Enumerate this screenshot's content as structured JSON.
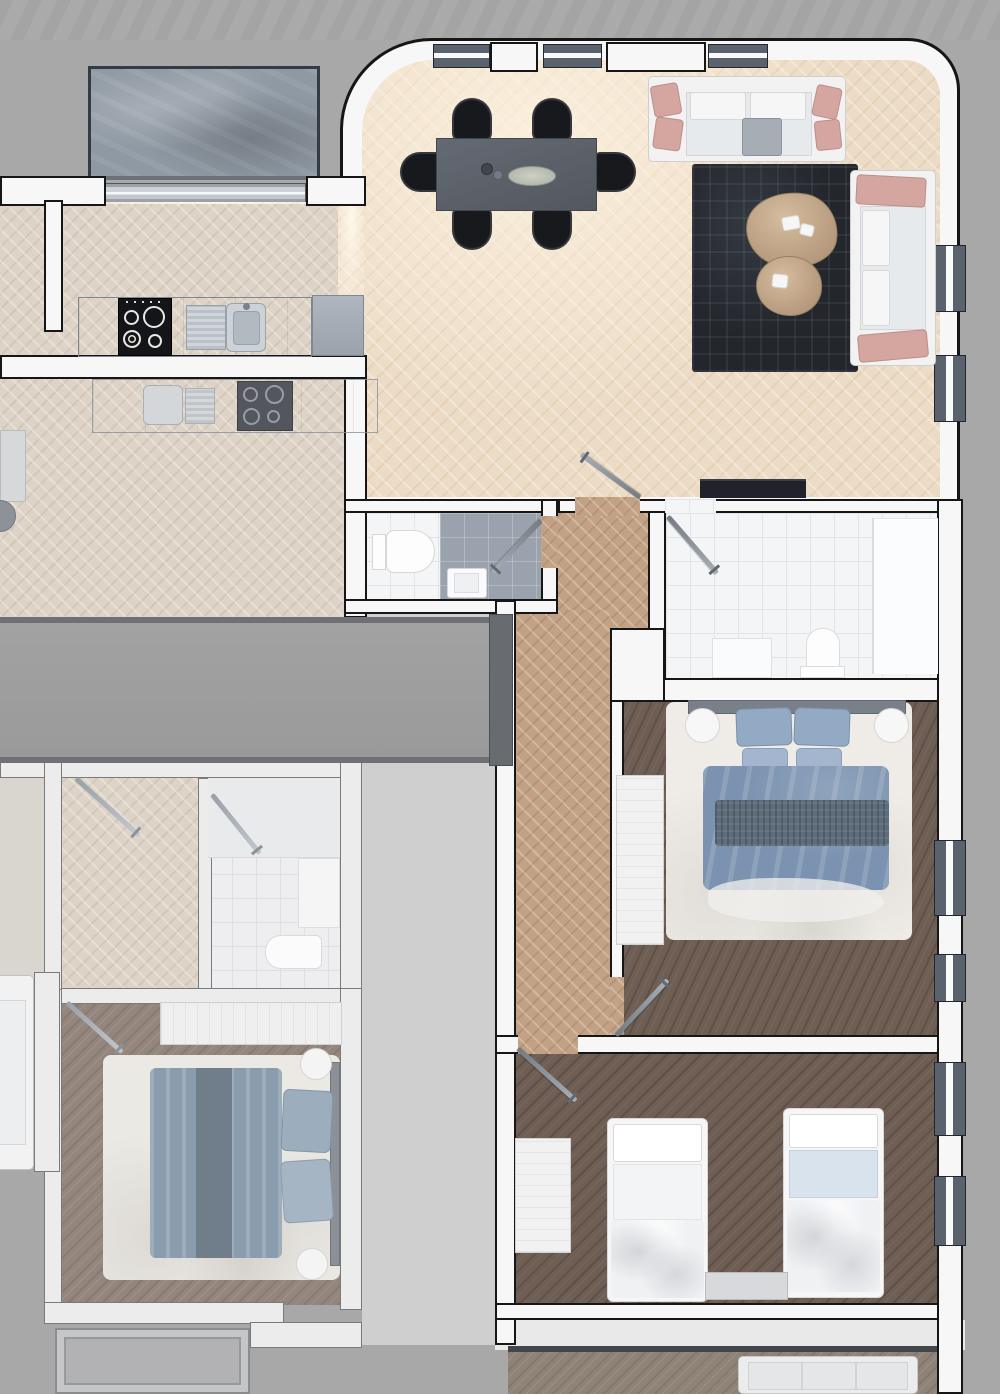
{
  "title": "apartment-building-floor-plan-render",
  "palette": {
    "bg": "#a8a8a8",
    "stripe_a": "#a1a1a1",
    "stripe_b": "#acacac",
    "wall_fill": "#f7f7f7",
    "wall_line": "#161616",
    "washed_wall_fill": "#ececec",
    "washed_wall_line": "#7a7a7a",
    "window_frame": "#5a626e",
    "glass_white": "#fafafa",
    "floor_living": "#ecdcc6",
    "floor_kitchen": "#f4e6d2",
    "floor_hall": "#c2a184",
    "floor_wood": "#6f5e53",
    "floor_wood_washed": "#94867c",
    "floor_corridor": "#9e9e9e",
    "gap_gray": "#cfcfcf",
    "tile_white": "#f4f5f7",
    "tile_line": "#e2e4e8",
    "shower_gray": "#9aa3ad",
    "rug_dark": "#23262c",
    "rug_light": "#efece7",
    "sofa_white": "#f2f2f2",
    "seat_gray": "#e7eaed",
    "pillow_blush": "#d5a6a0",
    "table_dark": "#5b6169",
    "chair_black": "#17191d",
    "wood_table": "#c4ab8d",
    "counter_gray": "#a0a9b2",
    "steel": "#c9d0d6",
    "cooktop_black": "#141518",
    "duvet_blue": "#7b93b0",
    "duvet_dark": "#5e6d7b",
    "pillow_blue": "#93aac4",
    "bed_white": "#f6f6f7",
    "blanket_blue": "#d9e3ed",
    "washed_duvet": "#8a9dae",
    "washed_duvet_dark": "#6d7a86",
    "stone": "#8f99a3",
    "terrace_border": "#343b42",
    "door_gray": "#8a9098",
    "balcony": "#b2b2b4",
    "tv_dark": "#202329",
    "corridor_wall": "#6e7074"
  },
  "scene": {
    "view": "top-down-3d-render",
    "units": [
      {
        "id": "main-apartment",
        "rooms": [
          {
            "name": "living-dining-room",
            "floor": "light-herringbone-parquet",
            "furniture": [
              "dining-table",
              "dining-chairs-x6",
              "serving-platter",
              "sofa-top",
              "sofa-right",
              "dark-area-rug",
              "coffee-table-large",
              "coffee-table-small",
              "tv-sideboard"
            ]
          },
          {
            "name": "kitchen-nook",
            "floor": "light-herringbone-parquet",
            "furniture": [
              "counter",
              "cooktop-4-burners",
              "sink-with-drainboard",
              "tall-cabinet"
            ]
          },
          {
            "name": "wc",
            "floor": "white-tile-and-gray-shower",
            "furniture": [
              "toilet",
              "washbasin",
              "shower-glass-door"
            ]
          },
          {
            "name": "bathroom",
            "floor": "white-tile",
            "furniture": [
              "vanity-unit",
              "toilet",
              "bathtub-shower-panel"
            ]
          },
          {
            "name": "master-bedroom",
            "floor": "dark-plank-wood",
            "furniture": [
              "double-bed-blue-duvet",
              "pillows-x4",
              "knit-throw",
              "white-shag-rug",
              "round-nightstand-left",
              "round-nightstand-right",
              "wardrobe"
            ]
          },
          {
            "name": "kids-bedroom",
            "floor": "dark-plank-wood",
            "furniture": [
              "single-bed-left",
              "single-bed-right-blue-blanket",
              "nightstand",
              "dresser"
            ]
          },
          {
            "name": "hallway",
            "floor": "tan-herringbone-parquet",
            "furniture": []
          },
          {
            "name": "terrace",
            "floor": "stone-slab",
            "furniture": []
          }
        ]
      },
      {
        "id": "neighbor-apartment-left",
        "rendering": "washed-out",
        "rooms": [
          {
            "name": "kitchen-living",
            "furniture": [
              "counter",
              "sink",
              "cooktop",
              "partial-round-table",
              "partial-cabinet"
            ]
          },
          {
            "name": "corridor",
            "furniture": []
          },
          {
            "name": "hallway",
            "furniture": []
          },
          {
            "name": "bathroom",
            "furniture": [
              "vanity",
              "toilet",
              "shower-panel"
            ]
          },
          {
            "name": "bedroom",
            "furniture": [
              "double-bed-blue-duvet",
              "wardrobe",
              "round-nightstand-x2",
              "white-rug"
            ]
          },
          {
            "name": "living-sofa-partial",
            "furniture": [
              "white-sofa"
            ]
          },
          {
            "name": "balcony",
            "furniture": []
          }
        ]
      },
      {
        "id": "neighbor-apartment-bottom",
        "rendering": "washed-out",
        "rooms": [
          {
            "name": "living-partial",
            "furniture": [
              "light-sofa"
            ]
          }
        ]
      }
    ],
    "doors_count": 8,
    "windows_count": 11
  }
}
